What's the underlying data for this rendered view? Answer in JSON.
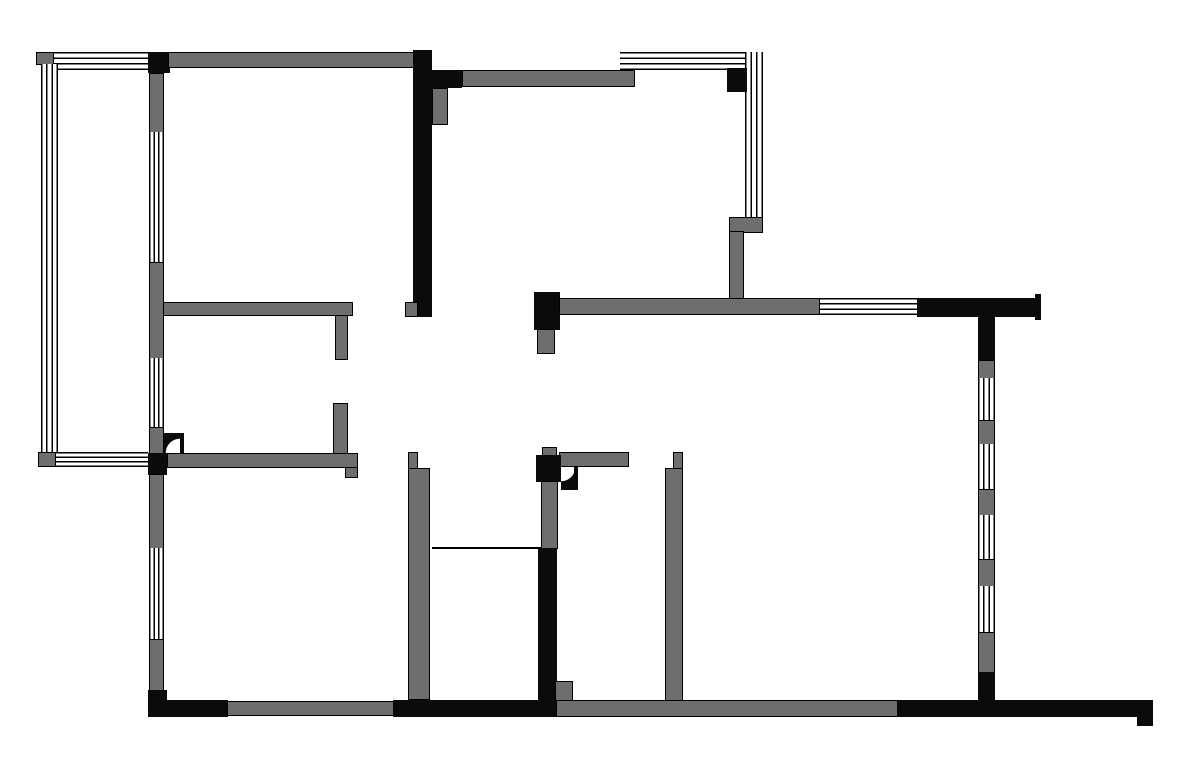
{
  "title": "apartment-floor-plan",
  "canvas": {
    "width": 1200,
    "height": 777,
    "background": "#ffffff"
  },
  "colors": {
    "wall_black": "#0b0b0b",
    "wall_gray": "#6e6e6e",
    "outline": "#000000",
    "window_bg": "#ffffff"
  },
  "elements": [
    {
      "name": "corner-post-top-left",
      "kind": "black",
      "x": 148,
      "y": 52,
      "w": 22,
      "h": 21
    },
    {
      "name": "wall-top-exterior",
      "kind": "gray",
      "x": 168,
      "y": 52,
      "w": 246,
      "h": 16
    },
    {
      "name": "wall-vertical-black-center-top",
      "kind": "black",
      "x": 413,
      "y": 50,
      "w": 19,
      "h": 267
    },
    {
      "name": "wall-black-kitchen-stub",
      "kind": "black",
      "x": 432,
      "y": 70,
      "w": 30,
      "h": 18
    },
    {
      "name": "wall-kitchen-top",
      "kind": "gray",
      "x": 462,
      "y": 70,
      "w": 173,
      "h": 17
    },
    {
      "name": "pier-kitchen-gray",
      "kind": "gray",
      "x": 432,
      "y": 88,
      "w": 16,
      "h": 37
    },
    {
      "name": "notch-gray-center-bar-bottom",
      "kind": "gray",
      "x": 405,
      "y": 302,
      "w": 13,
      "h": 15
    },
    {
      "name": "balcony-corner-gray-top-left",
      "kind": "gray",
      "x": 36,
      "y": 52,
      "w": 18,
      "h": 13
    },
    {
      "name": "window-balcony-top",
      "kind": "window-h",
      "x": 54,
      "y": 52,
      "w": 94,
      "h": 18
    },
    {
      "name": "window-balcony-left",
      "kind": "window-v",
      "x": 41,
      "y": 64,
      "w": 17,
      "h": 389
    },
    {
      "name": "balcony-corner-gray-bottom-left",
      "kind": "gray",
      "x": 38,
      "y": 452,
      "w": 18,
      "h": 15
    },
    {
      "name": "window-balcony-bottom",
      "kind": "window-h",
      "x": 56,
      "y": 452,
      "w": 92,
      "h": 15
    },
    {
      "name": "wall-left-upper-1",
      "kind": "gray",
      "x": 149,
      "y": 73,
      "w": 15,
      "h": 60
    },
    {
      "name": "window-left-upper",
      "kind": "window-v",
      "x": 149,
      "y": 132,
      "w": 15,
      "h": 131
    },
    {
      "name": "wall-left-mid",
      "kind": "gray",
      "x": 149,
      "y": 262,
      "w": 15,
      "h": 97
    },
    {
      "name": "window-left-mid",
      "kind": "window-v",
      "x": 149,
      "y": 358,
      "w": 15,
      "h": 70
    },
    {
      "name": "door-jamb-left",
      "kind": "gray",
      "x": 149,
      "y": 427,
      "w": 15,
      "h": 27
    },
    {
      "name": "door-arc-bedroom-left",
      "kind": "door-a",
      "x": 164,
      "y": 433,
      "w": 20,
      "h": 20
    },
    {
      "name": "post-black-left-wall",
      "kind": "black",
      "x": 148,
      "y": 453,
      "w": 19,
      "h": 22
    },
    {
      "name": "wall-left-lower-1",
      "kind": "gray",
      "x": 149,
      "y": 474,
      "w": 15,
      "h": 75
    },
    {
      "name": "window-left-lower",
      "kind": "window-v",
      "x": 149,
      "y": 548,
      "w": 15,
      "h": 92
    },
    {
      "name": "wall-left-lower-2",
      "kind": "gray",
      "x": 149,
      "y": 639,
      "w": 15,
      "h": 52
    },
    {
      "name": "corner-black-bottom-left",
      "kind": "black",
      "x": 148,
      "y": 690,
      "w": 19,
      "h": 27
    },
    {
      "name": "wall-interior-upper-horizontal",
      "kind": "gray",
      "x": 163,
      "y": 302,
      "w": 190,
      "h": 14
    },
    {
      "name": "stub-door-upper",
      "kind": "gray",
      "x": 335,
      "y": 315,
      "w": 13,
      "h": 45
    },
    {
      "name": "stub-door-lower",
      "kind": "gray",
      "x": 333,
      "y": 403,
      "w": 15,
      "h": 51
    },
    {
      "name": "wall-interior-lower-horizontal",
      "kind": "gray",
      "x": 167,
      "y": 453,
      "w": 191,
      "h": 15
    },
    {
      "name": "step-interior-lower-wall",
      "kind": "gray",
      "x": 345,
      "y": 467,
      "w": 13,
      "h": 11
    },
    {
      "name": "window-bay-top",
      "kind": "window-h",
      "x": 620,
      "y": 52,
      "w": 143,
      "h": 18
    },
    {
      "name": "window-bay-right",
      "kind": "window-v",
      "x": 745,
      "y": 52,
      "w": 18,
      "h": 166
    },
    {
      "name": "post-black-bay-corner",
      "kind": "black",
      "x": 727,
      "y": 68,
      "w": 20,
      "h": 24
    },
    {
      "name": "wall-bay-bottom-wide",
      "kind": "gray",
      "x": 729,
      "y": 217,
      "w": 34,
      "h": 16
    },
    {
      "name": "wall-bay-bottom-narrow",
      "kind": "gray",
      "x": 729,
      "y": 231,
      "w": 15,
      "h": 72
    },
    {
      "name": "post-black-living-wall",
      "kind": "black",
      "x": 534,
      "y": 292,
      "w": 26,
      "h": 38
    },
    {
      "name": "stub-gray-below-post",
      "kind": "gray",
      "x": 537,
      "y": 329,
      "w": 18,
      "h": 25
    },
    {
      "name": "wall-living-horizontal",
      "kind": "gray",
      "x": 559,
      "y": 298,
      "w": 261,
      "h": 17
    },
    {
      "name": "window-living-east",
      "kind": "window-h",
      "x": 820,
      "y": 298,
      "w": 97,
      "h": 17
    },
    {
      "name": "wall-black-top-right",
      "kind": "black",
      "x": 917,
      "y": 298,
      "w": 118,
      "h": 19
    },
    {
      "name": "endcap-black-top-right",
      "kind": "black",
      "x": 1035,
      "y": 294,
      "w": 6,
      "h": 26
    },
    {
      "name": "wall-right-black-top",
      "kind": "black",
      "x": 978,
      "y": 298,
      "w": 17,
      "h": 62
    },
    {
      "name": "pier-right-1",
      "kind": "gray",
      "x": 978,
      "y": 360,
      "w": 17,
      "h": 19
    },
    {
      "name": "window-right-1",
      "kind": "window-v",
      "x": 978,
      "y": 378,
      "w": 17,
      "h": 43
    },
    {
      "name": "pier-right-2",
      "kind": "gray",
      "x": 978,
      "y": 420,
      "w": 17,
      "h": 25
    },
    {
      "name": "window-right-2",
      "kind": "window-v",
      "x": 978,
      "y": 444,
      "w": 17,
      "h": 46
    },
    {
      "name": "pier-right-3",
      "kind": "gray",
      "x": 978,
      "y": 489,
      "w": 17,
      "h": 27
    },
    {
      "name": "window-right-3",
      "kind": "window-v",
      "x": 978,
      "y": 515,
      "w": 17,
      "h": 45
    },
    {
      "name": "pier-right-4",
      "kind": "gray",
      "x": 978,
      "y": 559,
      "w": 17,
      "h": 28
    },
    {
      "name": "window-right-4",
      "kind": "window-v",
      "x": 978,
      "y": 586,
      "w": 17,
      "h": 47
    },
    {
      "name": "pier-right-5",
      "kind": "gray",
      "x": 978,
      "y": 632,
      "w": 17,
      "h": 41
    },
    {
      "name": "wall-right-black-bottom",
      "kind": "black",
      "x": 978,
      "y": 672,
      "w": 17,
      "h": 45
    },
    {
      "name": "wall-corridor-left-top-strip",
      "kind": "gray",
      "x": 408,
      "y": 452,
      "w": 10,
      "h": 17
    },
    {
      "name": "wall-corridor-left",
      "kind": "gray",
      "x": 408,
      "y": 468,
      "w": 22,
      "h": 232
    },
    {
      "name": "wall-corridor-right-top-strip",
      "kind": "gray",
      "x": 673,
      "y": 452,
      "w": 10,
      "h": 17
    },
    {
      "name": "wall-corridor-right",
      "kind": "gray",
      "x": 665,
      "y": 468,
      "w": 18,
      "h": 235
    },
    {
      "name": "wall-bath-horizontal",
      "kind": "gray",
      "x": 559,
      "y": 452,
      "w": 70,
      "h": 15
    },
    {
      "name": "stub-gray-above-bath-post",
      "kind": "gray",
      "x": 542,
      "y": 447,
      "w": 15,
      "h": 9
    },
    {
      "name": "post-black-bath",
      "kind": "black",
      "x": 536,
      "y": 455,
      "w": 25,
      "h": 27
    },
    {
      "name": "door-arc-bath",
      "kind": "door-b",
      "x": 561,
      "y": 467,
      "w": 17,
      "h": 23
    },
    {
      "name": "wall-bath-gray-vertical",
      "kind": "gray",
      "x": 541,
      "y": 481,
      "w": 17,
      "h": 68
    },
    {
      "name": "wall-bath-black-vertical",
      "kind": "black",
      "x": 538,
      "y": 548,
      "w": 19,
      "h": 152
    },
    {
      "name": "line-threshold",
      "kind": "line",
      "x": 432,
      "y": 547,
      "w": 109,
      "h": 2
    },
    {
      "name": "wall-bottom-black-left",
      "kind": "black",
      "x": 148,
      "y": 700,
      "w": 80,
      "h": 17
    },
    {
      "name": "wall-bottom-gray-left",
      "kind": "gray",
      "x": 227,
      "y": 701,
      "w": 167,
      "h": 15
    },
    {
      "name": "wall-bottom-black-mid",
      "kind": "black",
      "x": 393,
      "y": 700,
      "w": 164,
      "h": 17
    },
    {
      "name": "notch-gray-bottom-center",
      "kind": "gray",
      "x": 555,
      "y": 681,
      "w": 18,
      "h": 20
    },
    {
      "name": "wall-bottom-gray-right",
      "kind": "gray",
      "x": 556,
      "y": 700,
      "w": 342,
      "h": 17
    },
    {
      "name": "wall-bottom-black-right",
      "kind": "black",
      "x": 897,
      "y": 700,
      "w": 256,
      "h": 17
    },
    {
      "name": "step-black-bottom-right",
      "kind": "black",
      "x": 1137,
      "y": 717,
      "w": 16,
      "h": 9
    }
  ]
}
